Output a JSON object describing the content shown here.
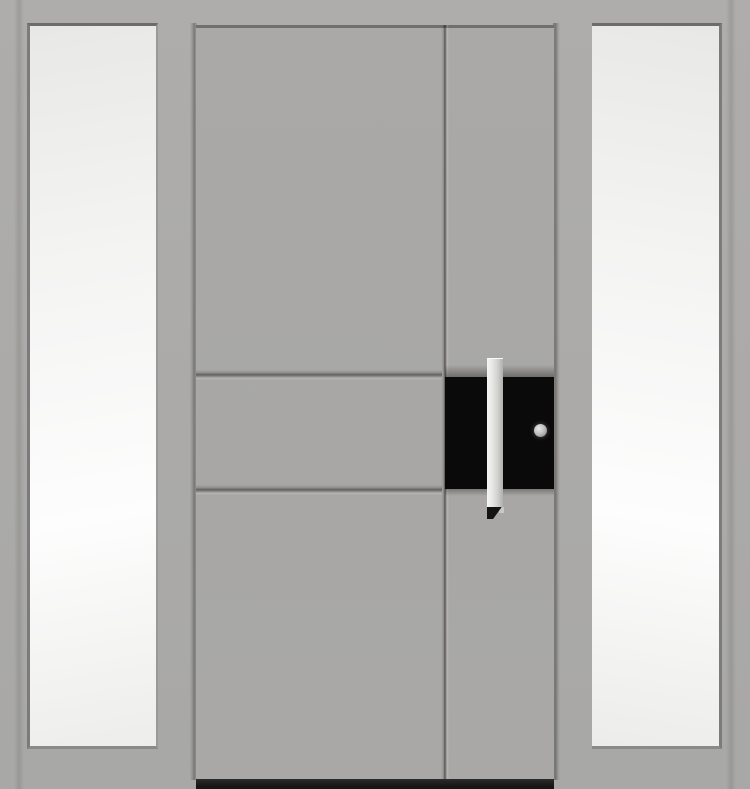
{
  "meta": {
    "type": "product-image",
    "subject": "Modern grey entrance door with black accent panel, vertical bar handle and two glazed sidelights"
  },
  "colors": {
    "wall_gray_top": "#aeadab",
    "wall_gray": "#abaaa8",
    "wall_gray_bottom": "#a8a8a6",
    "leaf_gray": "#aaa9a7",
    "glass_light": "#fdfdfd",
    "glass_shade": "#e8e8e7",
    "edge_dark": "#6c6c6c",
    "accent_black": "#0a0a0a",
    "handle_highlight": "#f5f5f3",
    "handle_silver": "#d2d2d0",
    "handle_shadow": "#b0b0ae",
    "handle_tip": "#141414",
    "lock_face": "#b9b9b9",
    "threshold_dark": "#161616"
  },
  "parts": {
    "assembly": "Entrance door with sidelights",
    "wall": "Frame surround",
    "left_sidelight": "Left sidelight glazing",
    "right_sidelight": "Right sidelight glazing",
    "door_leaf": "Door leaf",
    "vertical_groove": "Vertical panel groove",
    "upper_groove": "Upper horizontal panel groove",
    "lower_groove": "Lower horizontal panel groove",
    "accent_panel": "Black accent panel",
    "handle": "Vertical bar pull handle",
    "handle_end": "Handle end cap",
    "lock": "Profile cylinder lock",
    "threshold": "Door threshold"
  }
}
